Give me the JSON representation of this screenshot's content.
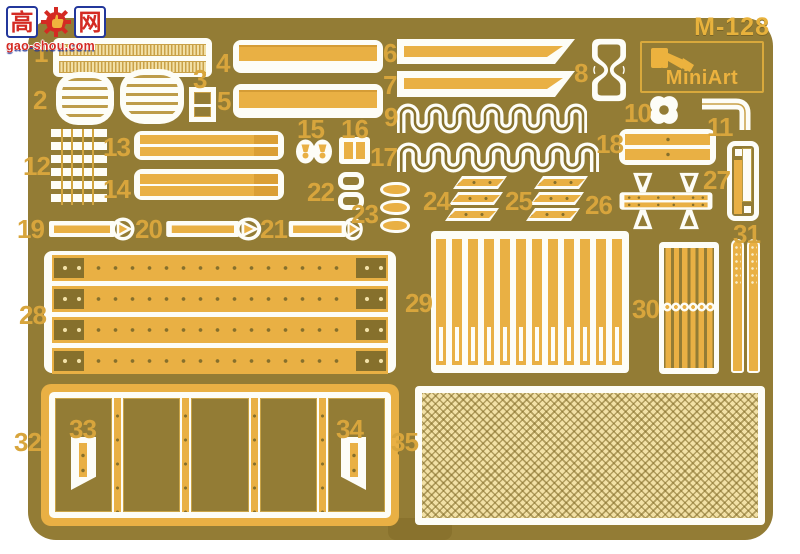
{
  "brand": {
    "sheet_code": "M-128",
    "brand_name": "MiniArt",
    "logo_icon": "excavator-icon"
  },
  "watermark": {
    "char_left": "高",
    "char_right": "网",
    "icon": "gear-thumbs-up-icon",
    "url": "gao-shou.com"
  },
  "part_labels": [
    "1",
    "2",
    "3",
    "4",
    "5",
    "6",
    "7",
    "8",
    "9",
    "10",
    "11",
    "12",
    "13",
    "14",
    "15",
    "16",
    "17",
    "18",
    "19",
    "20",
    "21",
    "22",
    "23",
    "24",
    "25",
    "26",
    "27",
    "28",
    "29",
    "30",
    "31",
    "32",
    "33",
    "34",
    "35"
  ],
  "colors": {
    "fret_olive": "#937c35",
    "hole_olive": "#86702c",
    "part_yellow": "#e9b044",
    "accent_yellow": "#db9f35",
    "pale_mesh": "#f2e1a6",
    "outline_white": "#fdfdf7",
    "label_yellow": "#d8a53c",
    "watermark_red": "#d42a23",
    "watermark_blue": "#23379b"
  }
}
